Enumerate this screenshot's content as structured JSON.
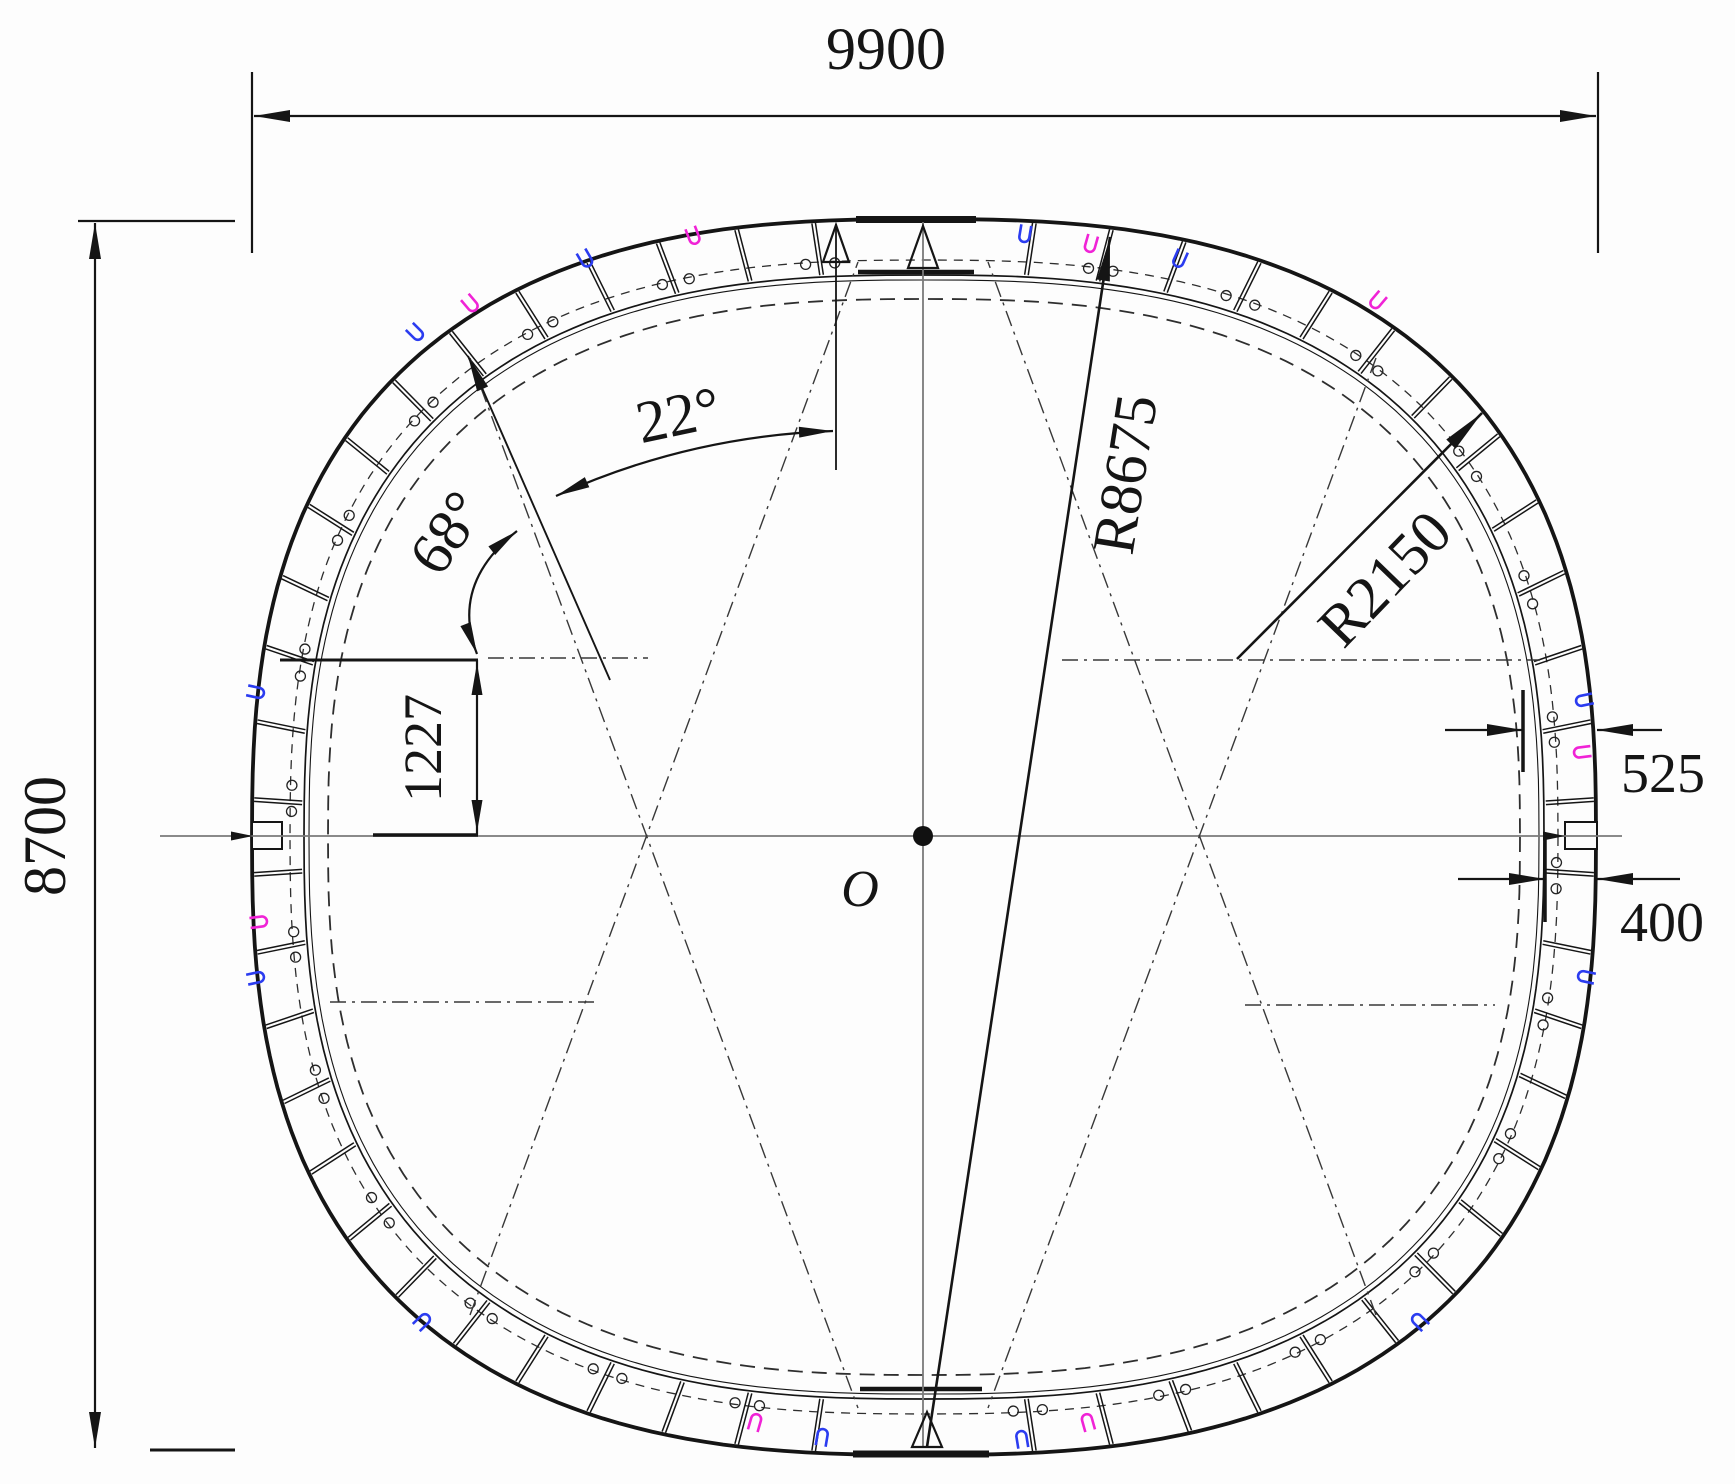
{
  "title": "Quasi-rectangular shield tunnel segmental lining cross-section drawing",
  "labels": {
    "overall_width": "9900",
    "overall_height": "8700",
    "corner_center_offset": "1227",
    "outer_clearance_thickness": "525",
    "segment_thickness": "400",
    "crown_half_angle": "22°",
    "corner_angle": "68°",
    "crown_radius": "R8675",
    "corner_radius": "R2150",
    "center_point": "O"
  },
  "colors": {
    "line": "#151515",
    "centerline": "#7a7a7a",
    "construction": "#383838",
    "bolt_blue": "#2b3cf0",
    "bolt_magenta": "#f023d6",
    "background": "#fdfdfd"
  }
}
